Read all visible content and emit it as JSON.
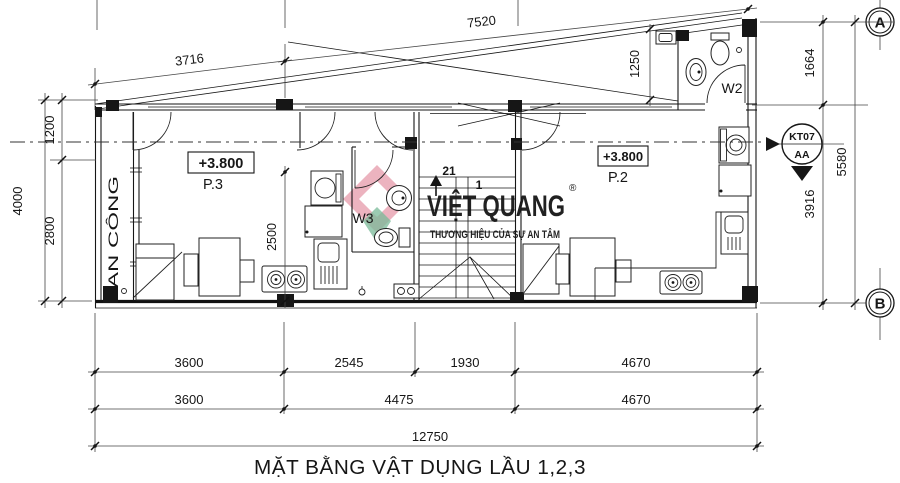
{
  "title": "MẶT BẰNG VẬT DỤNG LẦU 1,2,3",
  "watermark": {
    "brand": "VIỆT QUANG",
    "registered": "®",
    "tagline": "THƯƠNG HIỆU CỦA SỰ AN TÂM"
  },
  "grid_bubbles": {
    "a": "A",
    "b": "B"
  },
  "section_marker": {
    "code": "KT07",
    "label": "AA"
  },
  "rooms": {
    "p3_level": "+3.800",
    "p3_name": "P.3",
    "p2_level": "+3.800",
    "p2_name": "P.2",
    "w2": "W2",
    "w3": "W3",
    "balcony": "BAN CÔNG"
  },
  "stairs": {
    "step_top": "21",
    "step_first": "1"
  },
  "dims": {
    "top": {
      "d1": "3716",
      "d2": "7520",
      "d3": "1250"
    },
    "left": {
      "total": "4000",
      "d1": "1200",
      "d2": "2800"
    },
    "interior": {
      "d1": "2500"
    },
    "right": {
      "d1": "1664",
      "d2": "3916",
      "total": "5580"
    },
    "bottom_row1": [
      "3600",
      "2545",
      "1930",
      "4670"
    ],
    "bottom_row2": [
      "3600",
      "4475",
      "4670"
    ],
    "bottom_total": "12750"
  },
  "colors": {
    "line": "#161616",
    "wm_green": "#c6dccf",
    "wm_logo_green": "#79b998",
    "wm_logo_pink": "#e59aa9",
    "wm_pink": "#f2a9b9"
  }
}
